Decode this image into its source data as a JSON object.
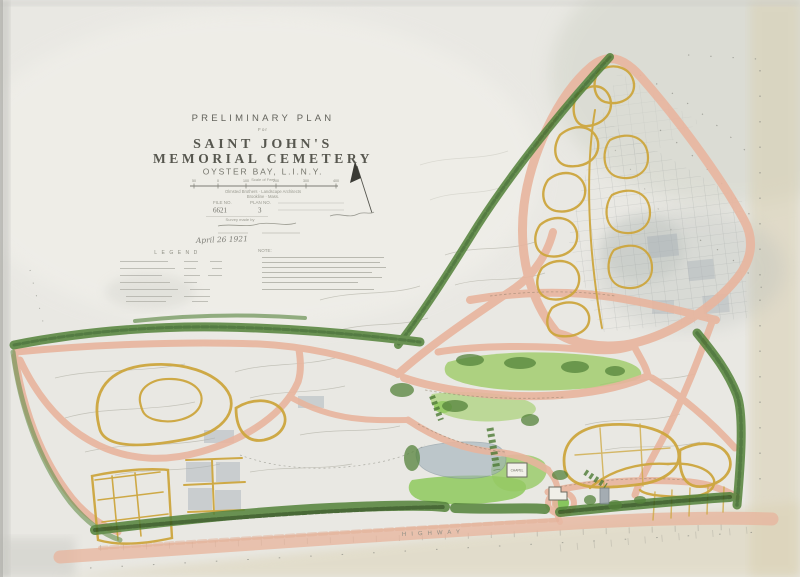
{
  "document": {
    "type_label": "PRELIMINARY PLAN",
    "for_label": "For",
    "title_line1": "SAINT JOHN'S",
    "title_line2": "MEMORIAL CEMETERY",
    "location_line": "OYSTER BAY, L.I.N.Y.",
    "scale_caption": "Scale of Feet",
    "scale_ticks": [
      "50",
      "0",
      "100",
      "200",
      "300",
      "400"
    ],
    "firm_line1": "Olmsted Brothers · Landscape Architects",
    "firm_line2": "Brookline · Mass.",
    "file_no_label": "FILE NO.",
    "file_no_value": "6621",
    "plan_no_label": "PLAN NO.",
    "plan_no_value": "3",
    "survey_line": "Survey made by",
    "date_annotation": "April 26 1921",
    "legend_heading": "LEGEND",
    "note_heading": "NOTE:"
  },
  "map_labels": {
    "chapel": "CHAPEL",
    "highway": "HIGHWAY"
  },
  "palette": {
    "paper": "#e9e8e3",
    "road_pink": "#e8b59e",
    "path_yellow": "#cda63e",
    "lawn_green": "#9ecb67",
    "tree_green": "#55833b",
    "water_gray": "#9fb0ba",
    "pencil_gray": "#8f9088",
    "margin_tan": "#dbd2b4"
  }
}
